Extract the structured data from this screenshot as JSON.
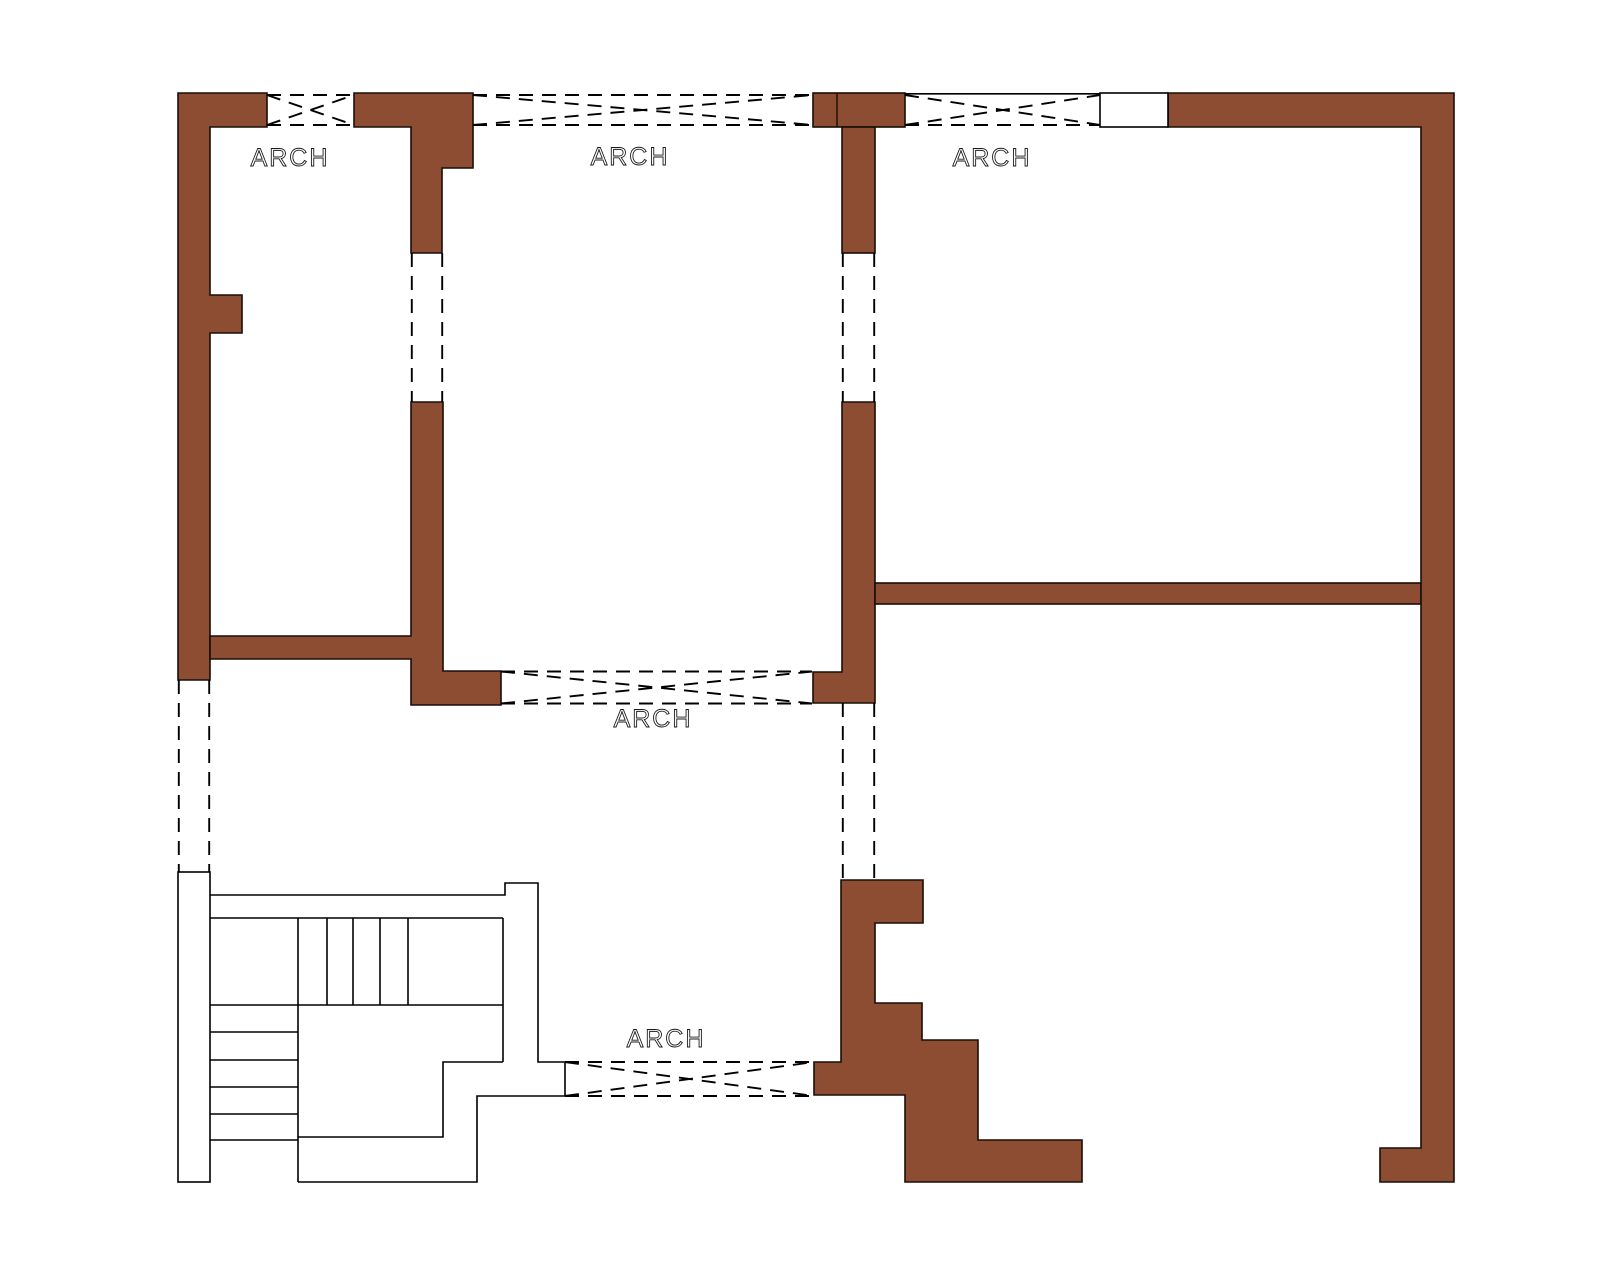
{
  "drawing": {
    "type": "architectural-floor-plan",
    "background_color": "#ffffff",
    "wall_fill_color": "#8C4D33",
    "wall_stroke_color": "#1A0E08",
    "line_color": "#000000",
    "labels": {
      "arch_top_left": "ARCH",
      "arch_top_middle": "ARCH",
      "arch_top_right": "ARCH",
      "arch_middle": "ARCH",
      "arch_bottom": "ARCH"
    },
    "features": {
      "arch_openings_count": 5,
      "rooms": [
        "top-left room",
        "top-middle room",
        "right room",
        "lower hall with staircase"
      ],
      "staircase": "two flights with landing, bottom-left",
      "wall_openings": "dashed lines mark unbuilt / open wall segments"
    }
  }
}
